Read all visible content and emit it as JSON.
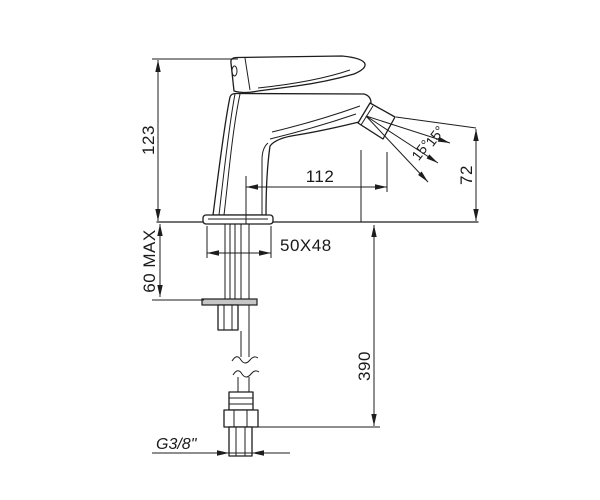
{
  "drawing": {
    "title": "Single-lever bidet mixer faucet — side elevation installation drawing",
    "units": "mm",
    "line_color": "#1d1d1d",
    "background_color": "#ffffff",
    "labels": {
      "height_above_deck": "123",
      "max_deck_thickness": "60 MAX",
      "spout_reach": "112",
      "base_dimensions": "50X48",
      "outlet_height": "72",
      "hose_length": "390",
      "thread_size": "G3/8\"",
      "swivel_angle_left": "15°",
      "swivel_angle_right": "15°"
    }
  }
}
